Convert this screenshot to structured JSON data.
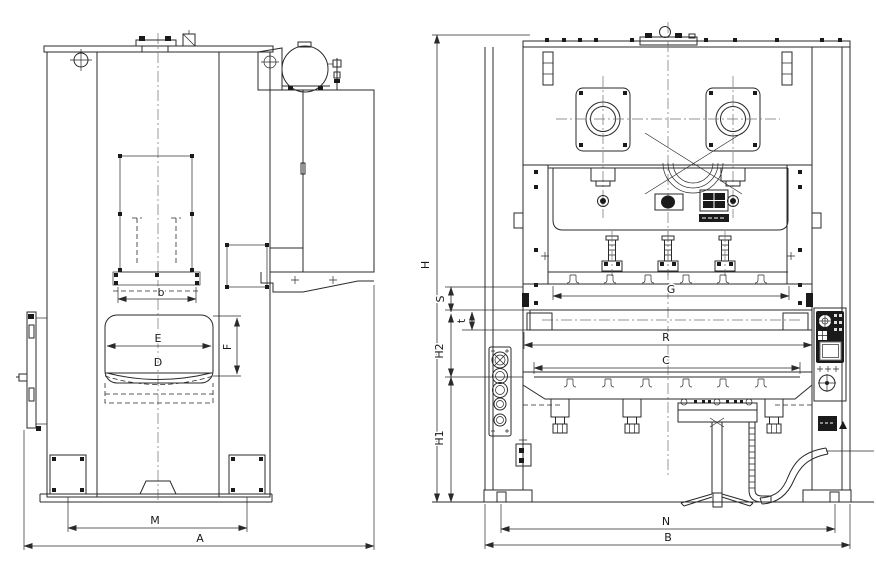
{
  "colors": {
    "line": "#2a2a2a",
    "background": "#ffffff",
    "fill_dark": "#1a1a1a"
  },
  "labels": {
    "side": {
      "slide_pad": "b",
      "opening_width": "E",
      "opening_depth": "D",
      "opening_height": "F",
      "anchor_span": "M",
      "overall_depth": "A"
    },
    "front": {
      "overall_height": "H",
      "stroke": "S",
      "plate_thickness": "t",
      "upper_height": "H2",
      "lower_height": "H1",
      "slide_width": "G",
      "rail_width": "R",
      "bolster_width": "C",
      "anchor_span": "N",
      "overall_width": "B"
    }
  }
}
